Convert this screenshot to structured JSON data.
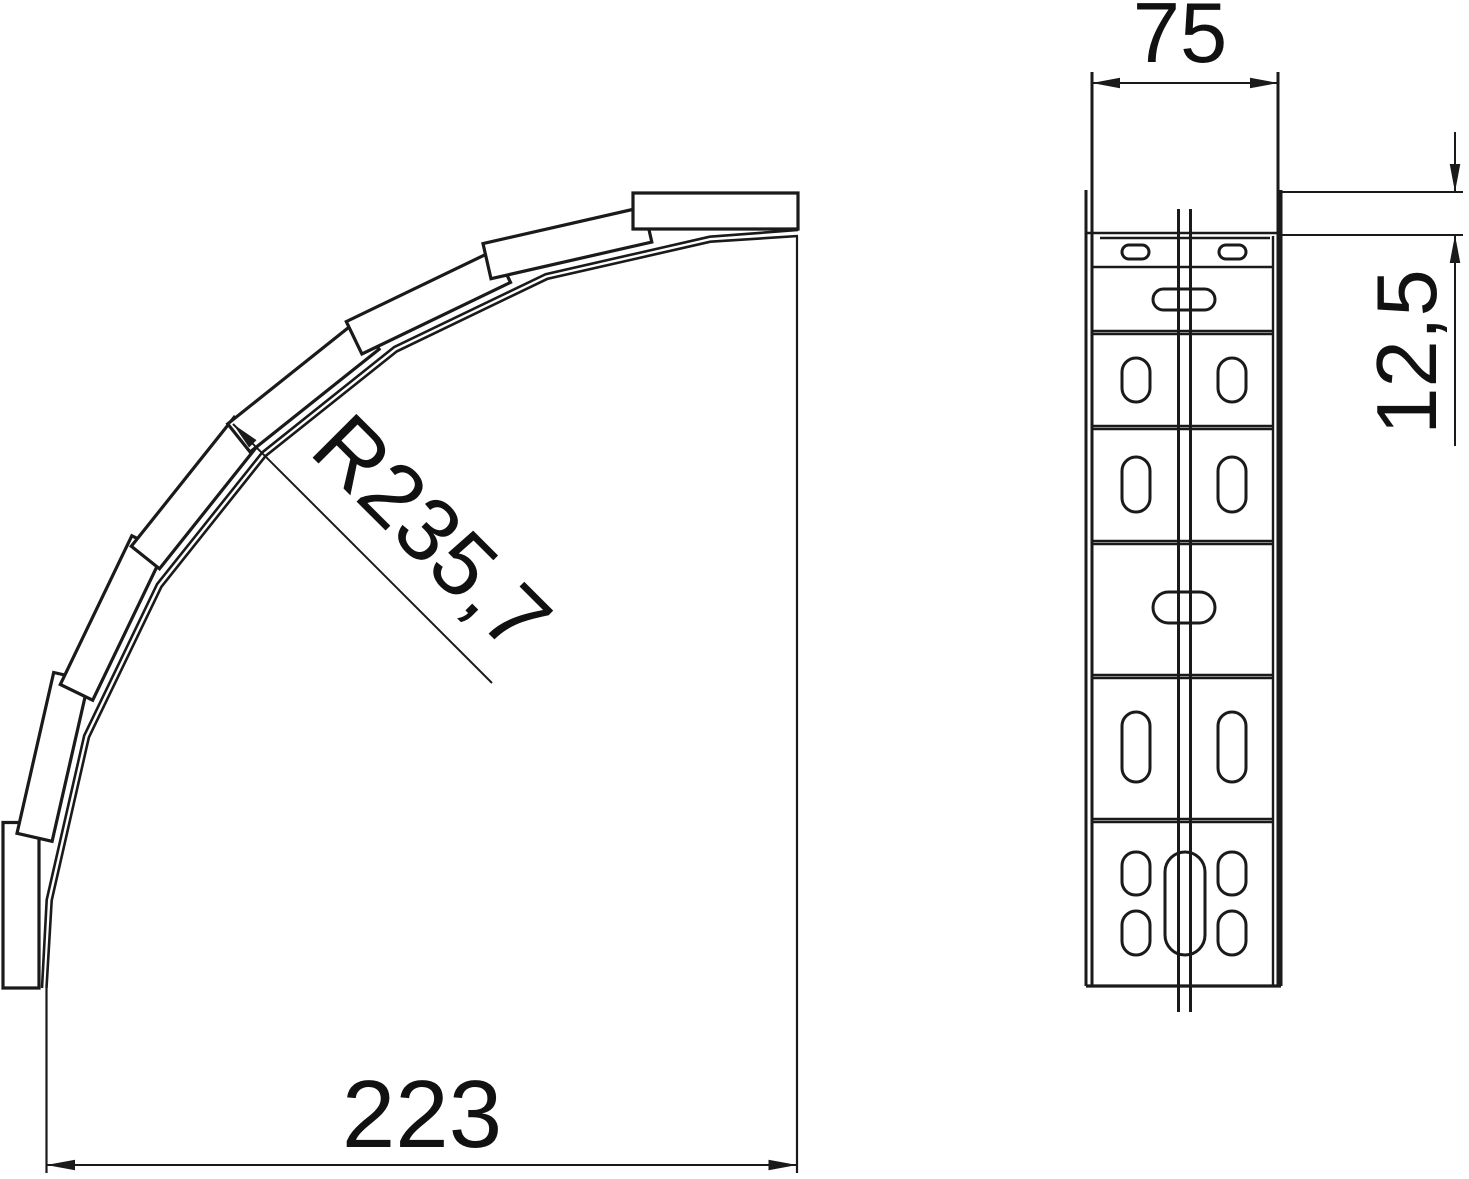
{
  "colors": {
    "background": "#ffffff",
    "ink": "#1a1a1a",
    "text": "#111111"
  },
  "views": {
    "plan": {
      "label": "plan-view-of-90-degree-bend",
      "dimensions": {
        "width": "223",
        "radius": "R235,7"
      }
    },
    "side": {
      "label": "side-view-of-perforated-flange",
      "dimensions": {
        "width": "75",
        "flange_height": "12,5"
      }
    }
  }
}
